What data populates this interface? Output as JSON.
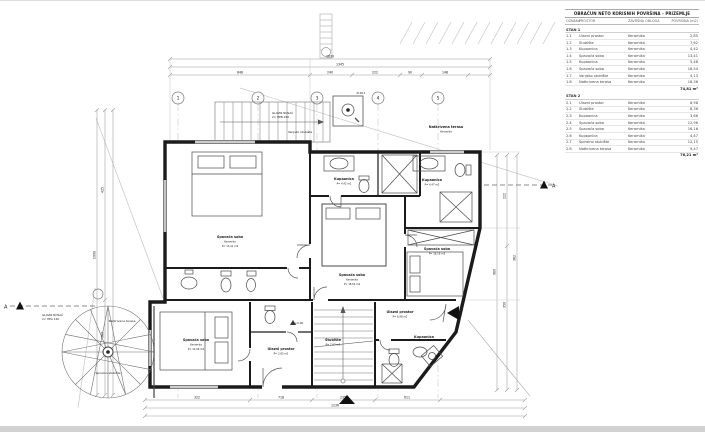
{
  "table": {
    "title": "OBRAČUN NETO KORISNIH POVRŠINA - PRIZEMLJE",
    "columns": [
      "OZNAKA",
      "PROSTOR",
      "ZAVRŠNA OBLOGA",
      "POVRŠINA (m2)"
    ],
    "sections": [
      {
        "name": "STAN 1",
        "rows": [
          {
            "oznaka": "1.1",
            "prostor": "Ulazni prostor",
            "obloga": "Keramika",
            "povrsina": "2,85"
          },
          {
            "oznaka": "1.2",
            "prostor": "Stubište",
            "obloga": "Keramika",
            "povrsina": "7,62"
          },
          {
            "oznaka": "1.3",
            "prostor": "Kupaonica",
            "obloga": "Keramika",
            "povrsina": "4,42"
          },
          {
            "oznaka": "1.4",
            "prostor": "Spavaća soba",
            "obloga": "Keramika",
            "povrsina": "13,41"
          },
          {
            "oznaka": "1.5",
            "prostor": "Kupaonica",
            "obloga": "Keramika",
            "povrsina": "5,48"
          },
          {
            "oznaka": "1.6",
            "prostor": "Spavaća soba",
            "obloga": "Keramika",
            "povrsina": "18,54"
          },
          {
            "oznaka": "1.7",
            "prostor": "Vanjsko stubište",
            "obloga": "Keramika",
            "povrsina": "4,13"
          },
          {
            "oznaka": "1.8",
            "prostor": "Natkrivena terasa",
            "obloga": "Keramika",
            "povrsina": "18,36"
          }
        ],
        "total": "74,81 m²"
      },
      {
        "name": "STAN 2",
        "rows": [
          {
            "oznaka": "2.1",
            "prostor": "Ulazni prostor",
            "obloga": "Keramika",
            "povrsina": "8,98"
          },
          {
            "oznaka": "2.2",
            "prostor": "Stubište",
            "obloga": "Keramika",
            "povrsina": "8,36"
          },
          {
            "oznaka": "2.3",
            "prostor": "Kupaonica",
            "obloga": "Keramika",
            "povrsina": "3,66"
          },
          {
            "oznaka": "2.4",
            "prostor": "Spavaća soba",
            "obloga": "Keramika",
            "povrsina": "12,96"
          },
          {
            "oznaka": "2.5",
            "prostor": "Spavaća soba",
            "obloga": "Keramika",
            "povrsina": "16,16"
          },
          {
            "oznaka": "2.6",
            "prostor": "Kupaonica",
            "obloga": "Keramika",
            "povrsina": "4,47"
          },
          {
            "oznaka": "2.7",
            "prostor": "Spiralno stubište",
            "obloga": "Keramika",
            "povrsina": "12,15"
          },
          {
            "oznaka": "2.8",
            "prostor": "Natkrivena terasa",
            "obloga": "Keramika",
            "povrsina": "9,47"
          }
        ],
        "total": "76,21 m²"
      }
    ]
  },
  "plan": {
    "grid_bubbles": [
      "1",
      "2",
      "3",
      "4",
      "5"
    ],
    "section_label": "A",
    "level_mark": "+0,00",
    "rooms": {
      "bedroom_tl": {
        "name": "Spavaća soba",
        "finish": "Keramika",
        "area": "P= 13,41 m2"
      },
      "bath_c": {
        "name": "Kupaonica",
        "finish": "Keramika",
        "area": "P= 4,42 m2"
      },
      "bedroom_c": {
        "name": "Spavaća soba",
        "finish": "Keramika",
        "area": "P= 18,54 m2"
      },
      "bath_r": {
        "name": "Kupaonica",
        "finish": "Keramika",
        "area": "P= 4,47 m2"
      },
      "bedroom_r": {
        "name": "Spavaća soba",
        "finish": "Keramika",
        "area": "P= 16,16 m2"
      },
      "terrace_top": {
        "name": "Natkrivena terasa",
        "finish": "Keramika"
      },
      "bedroom_bl": {
        "name": "Spavaća soba",
        "finish": "Keramika",
        "area": "P= 12,96 m2"
      },
      "hall_bl": {
        "name": "Ulazni prostor",
        "finish": "Keramika",
        "area": "P= 2,85 m2"
      },
      "stair_b": {
        "name": "Stubište",
        "finish": "Keramika",
        "area": "P= 7,62 m2"
      },
      "hall_br": {
        "name": "Ulazni prostor",
        "finish": "Keramika",
        "area": "P= 8,98 m2"
      },
      "bath_br": {
        "name": "Kupaonica",
        "finish": "Keramika",
        "area": "P= 3,66 m2"
      },
      "spiral": {
        "name": "Spiralno stubište"
      },
      "terrace_bl": {
        "name": "Natkrivena terasa"
      },
      "ext_stair": {
        "name": "Vanjsko stubište"
      }
    },
    "notes": {
      "beam_top_1": "GLAVNI NOSAČ",
      "beam_top_2": "2× HEB 240",
      "beam_bl_1": "GLAVNI NOSAČ",
      "beam_bl_2": "2× HEA 140",
      "chimney": "Ø 48,3"
    },
    "dims": {
      "top": [
        "1630",
        "1345",
        "848",
        "240",
        "222",
        "90",
        "148"
      ],
      "bottom": [
        "322",
        "718",
        "235",
        "611",
        "1236"
      ],
      "left": [
        "425",
        "1090",
        "363"
      ],
      "right": [
        "222",
        "980",
        "350",
        "362"
      ]
    }
  }
}
